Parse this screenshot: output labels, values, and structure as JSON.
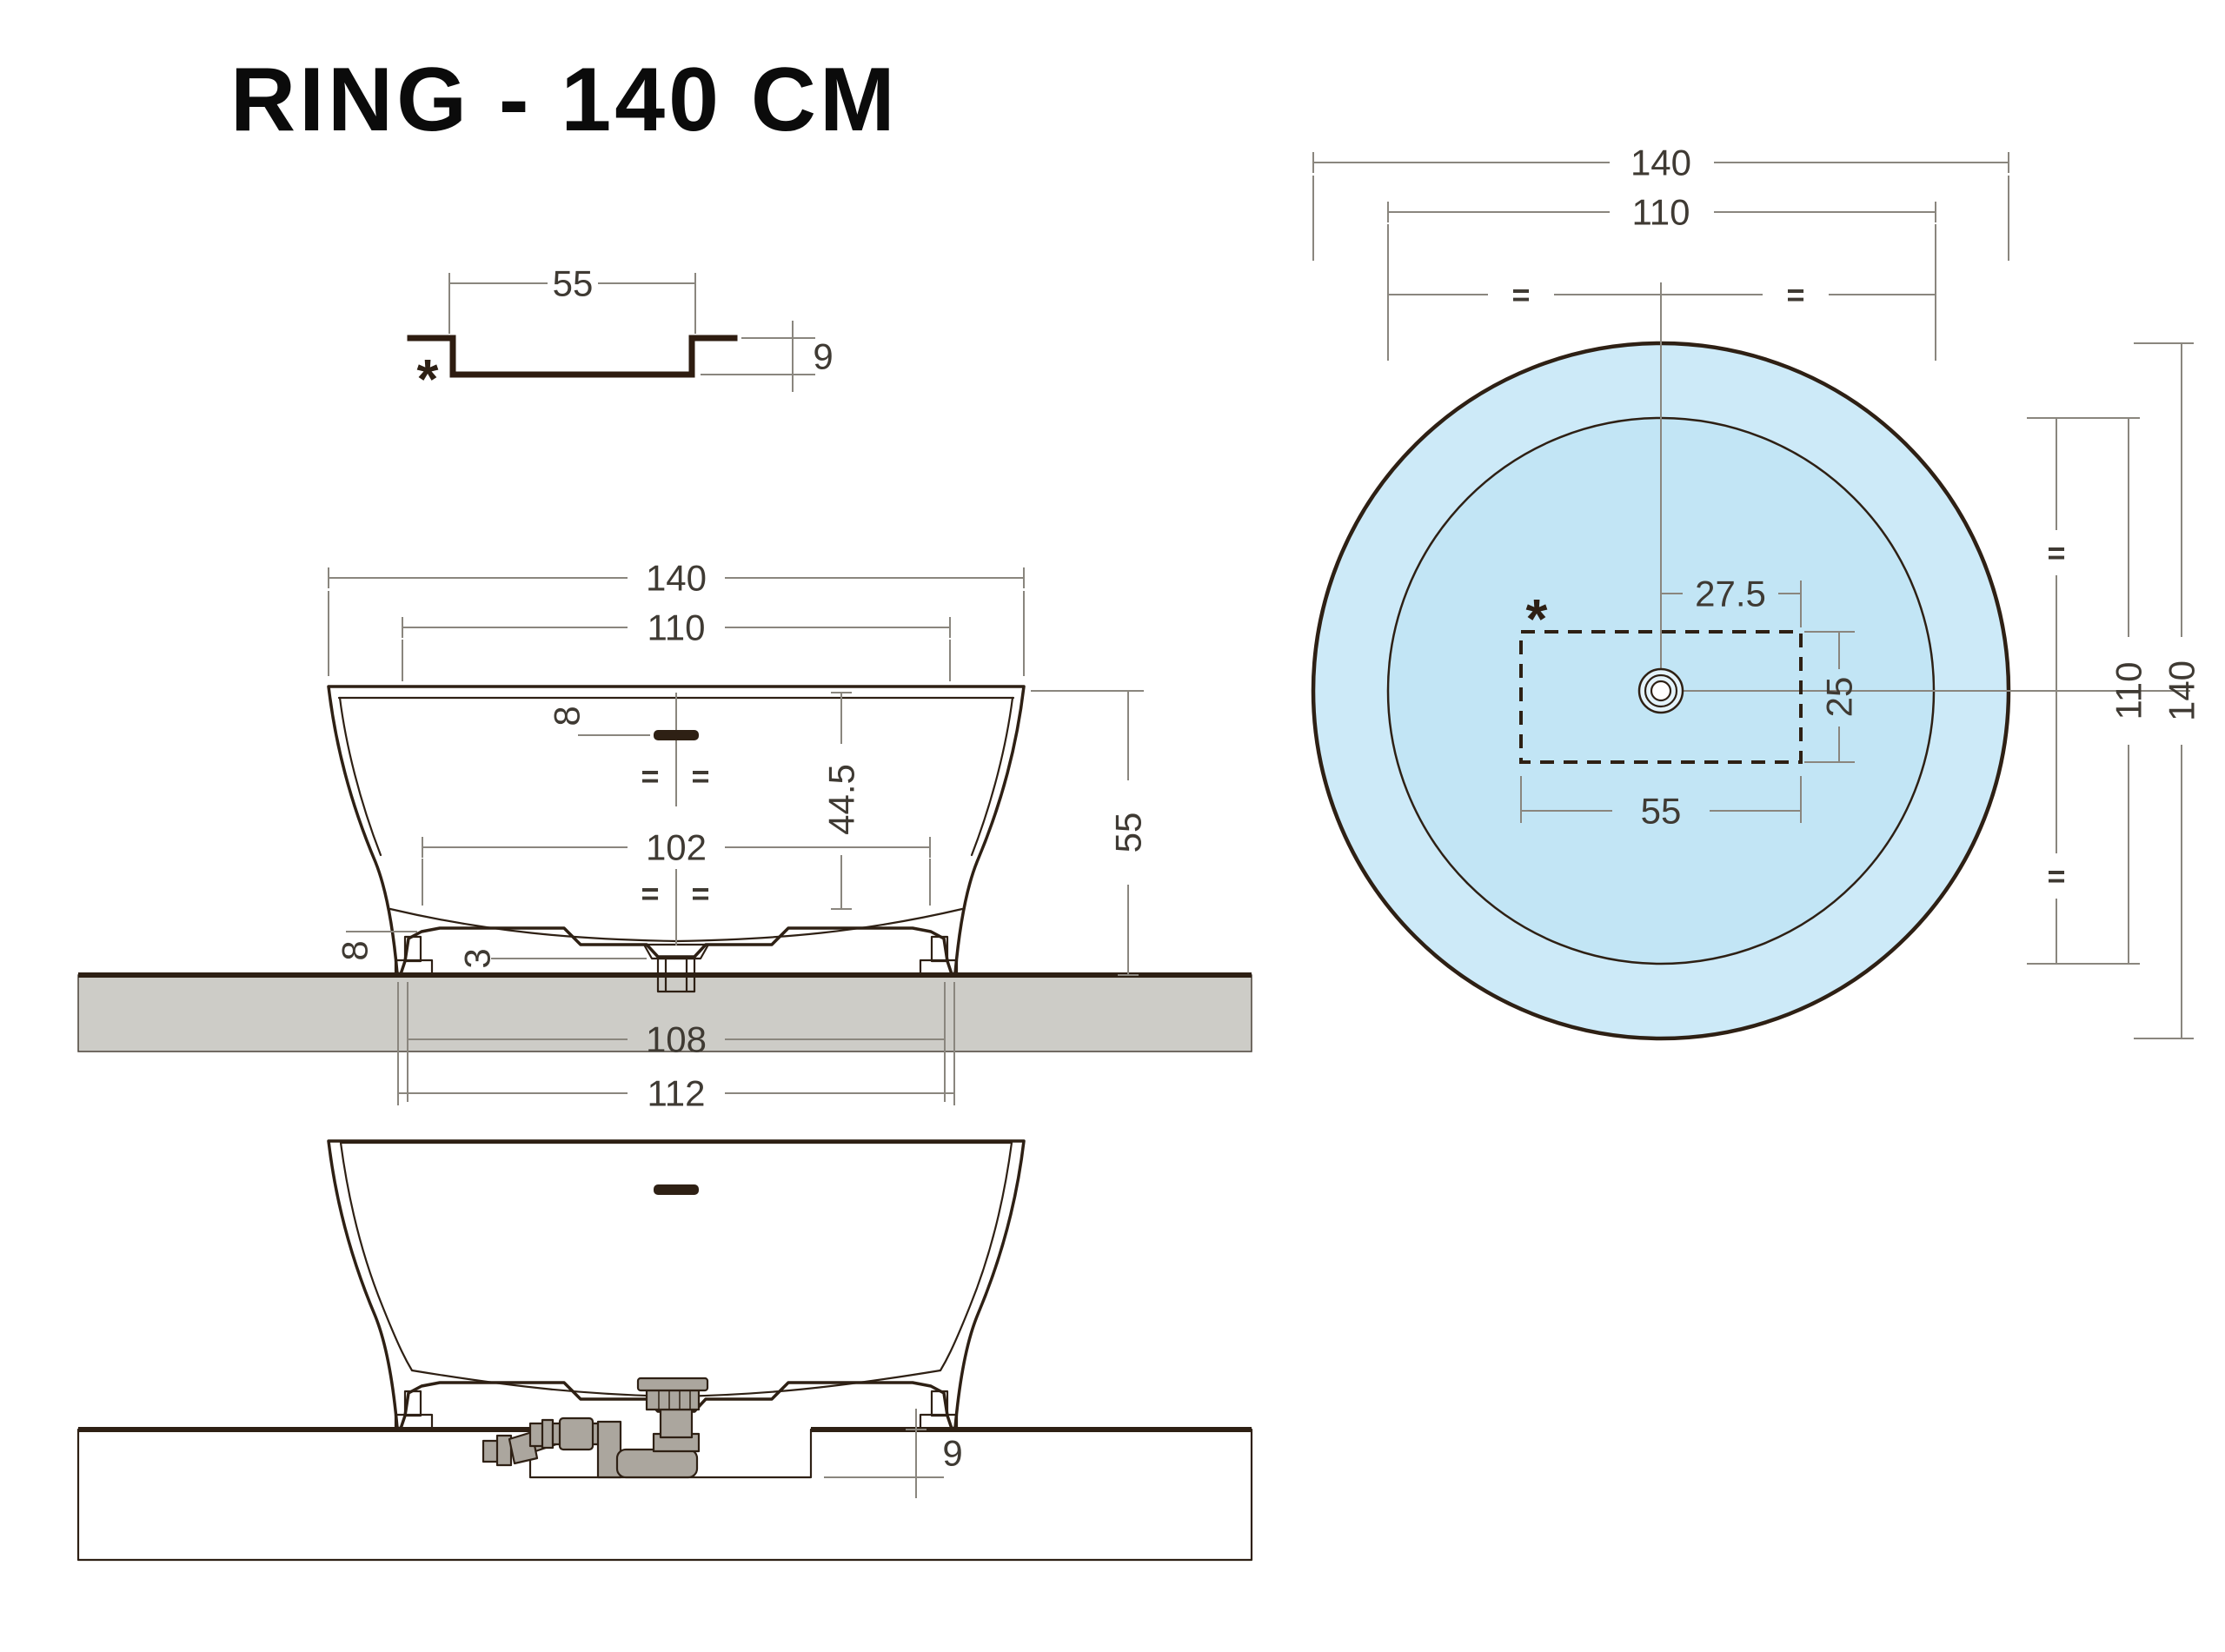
{
  "title": "RING - 140 CM",
  "detail": {
    "width": "55",
    "depth": "9",
    "note": "*"
  },
  "front": {
    "overall": "140",
    "rim": "110",
    "overflow_offset": "8",
    "eq1": "=",
    "eq2": "=",
    "depth": "44.5",
    "bottom_width": "102",
    "eq3": "=",
    "eq4": "=",
    "plinth_height": "8",
    "drain_gap": "3",
    "height": "55",
    "feet_span": "108",
    "base_span": "112"
  },
  "section": {
    "recess_depth": "9"
  },
  "plan": {
    "overall_w": "140",
    "rim_w": "110",
    "eq_left": "=",
    "eq_right": "=",
    "note": "*",
    "drain_offset": "27.5",
    "recess_h": "25",
    "recess_w": "55",
    "eq_top": "=",
    "eq_bottom": "=",
    "rim_h": "110",
    "overall_h": "140"
  },
  "colors": {
    "outline": "#2e2014",
    "dim_line": "#8a867e",
    "dim_text": "#3f3a33",
    "tub_blue": "#c2e5f6",
    "plan_ring": "#cdeaf8",
    "plan_inner": "#c2e5f5",
    "drain_fill": "#e4f3fb",
    "shell_cyan": "#58c7ea",
    "interior_gray": "#e3e2df",
    "slab_gray": "#cdccc7",
    "pipe_gray": "#aba69e",
    "slot_dark": "#2e2014",
    "title_color": "#0b0b0b",
    "white": "#ffffff"
  }
}
